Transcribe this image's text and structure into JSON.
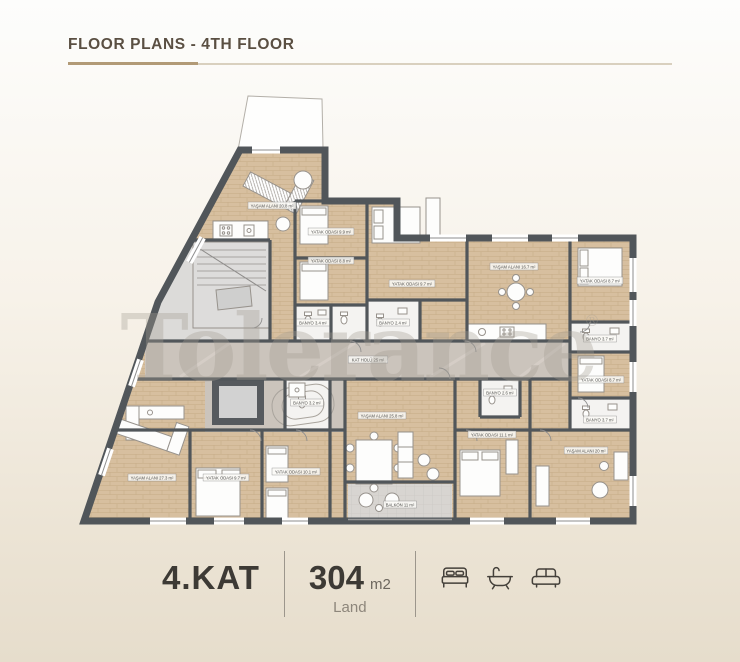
{
  "header": {
    "title": "FLOOR PLANS - 4TH FLOOR",
    "accent_color": "#b29a77",
    "rule_color": "#d9d0bf"
  },
  "watermark": {
    "text": "Tolerance",
    "registered": "®"
  },
  "floorplan": {
    "wall_color": "#51565a",
    "wood_color": "#d7bf9f",
    "corridor_color": "#cbc4bc",
    "labels": [
      {
        "t": "YAŞAM ALANI  20.8 m²",
        "x": 272,
        "y": 207
      },
      {
        "t": "YATAK ODASI  9.9 m²",
        "x": 331,
        "y": 233
      },
      {
        "t": "YATAK ODASI  8.8 m²",
        "x": 331,
        "y": 262
      },
      {
        "t": "YATAK ODASI  9.7 m²",
        "x": 412,
        "y": 285
      },
      {
        "t": "YAŞAM ALANI  16.7 m²",
        "x": 514,
        "y": 268
      },
      {
        "t": "YATAK ODASI  8.7 m²",
        "x": 600,
        "y": 282
      },
      {
        "t": "BANYO  3.4 m²",
        "x": 313,
        "y": 324
      },
      {
        "t": "BANYO  2.4 m²",
        "x": 393,
        "y": 324
      },
      {
        "t": "KAT HOLÜ   25 m²",
        "x": 368,
        "y": 361
      },
      {
        "t": "BANYO  3.7 m²",
        "x": 600,
        "y": 340
      },
      {
        "t": "YATAK ODASI  8.7 m²",
        "x": 601,
        "y": 381
      },
      {
        "t": "BANYO  3.7 m²",
        "x": 600,
        "y": 421
      },
      {
        "t": "YAŞAM ALANI  20 m²",
        "x": 586,
        "y": 452
      },
      {
        "t": "BANYO  3.2 m²",
        "x": 307,
        "y": 404
      },
      {
        "t": "YAŞAM ALANI  27.3 m²",
        "x": 152,
        "y": 479
      },
      {
        "t": "YATAK ODASI  9.7 m²",
        "x": 226,
        "y": 479
      },
      {
        "t": "YATAK ODASI  10.1 m²",
        "x": 296,
        "y": 473
      },
      {
        "t": "YAŞAM ALANI  25.8 m²",
        "x": 382,
        "y": 417
      },
      {
        "t": "BANYO  2.6 m²",
        "x": 500,
        "y": 394
      },
      {
        "t": "YATAK ODASI  11.1 m²",
        "x": 492,
        "y": 436
      },
      {
        "t": "BALKON  11 m²",
        "x": 400,
        "y": 506
      }
    ]
  },
  "footer": {
    "floor_label": "4.KAT",
    "area_value": "304",
    "area_unit": "m2",
    "area_type": "Land",
    "icons": [
      "bed-icon",
      "bathtub-icon",
      "sofa-icon"
    ]
  }
}
